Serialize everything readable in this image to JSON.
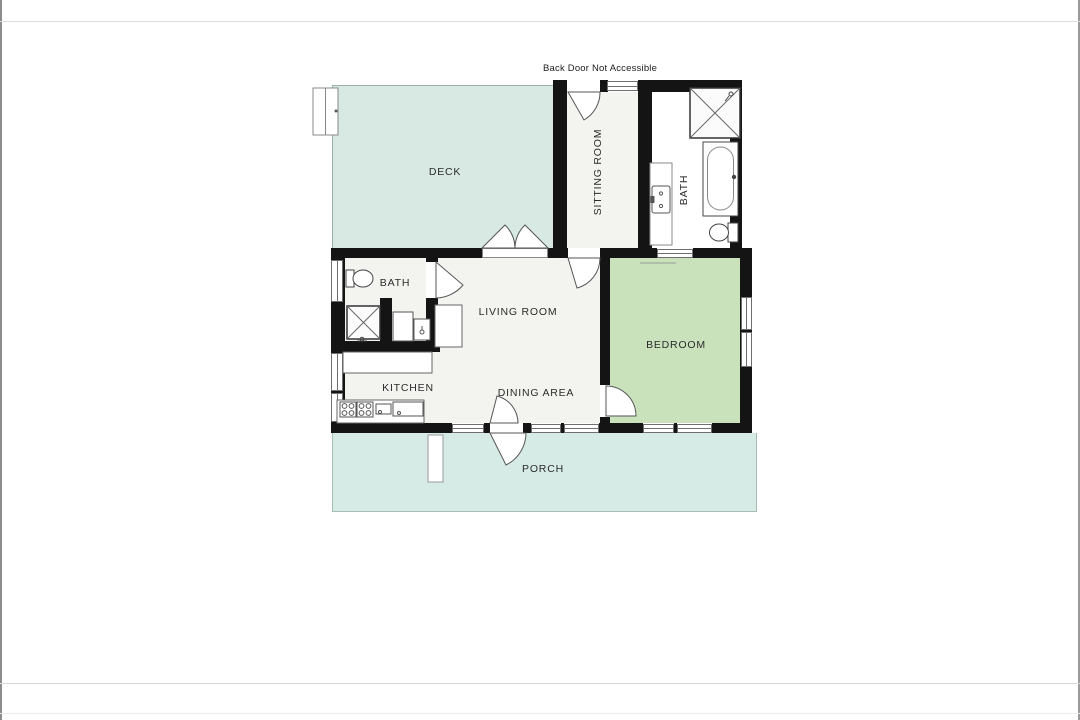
{
  "floor_plan": {
    "note_back_door": "Back Door Not Accessible",
    "rooms": {
      "deck": {
        "label": "DECK"
      },
      "sitting_room": {
        "label": "SITTING ROOM"
      },
      "bath_main": {
        "label": "BATH"
      },
      "bath_half": {
        "label": "BATH"
      },
      "living_room": {
        "label": "LIVING ROOM"
      },
      "dining_area": {
        "label": "DINING AREA"
      },
      "kitchen": {
        "label": "KITCHEN"
      },
      "bedroom": {
        "label": "BEDROOM"
      },
      "porch": {
        "label": "PORCH"
      }
    },
    "colors": {
      "wall": "#141414",
      "room": "#f3f3f0",
      "deck": "#d8e8e3",
      "porch": "#d7ebe6",
      "bath": "#cdddе5",
      "bedroom": "#c9e2bc",
      "line": "#666666"
    }
  }
}
